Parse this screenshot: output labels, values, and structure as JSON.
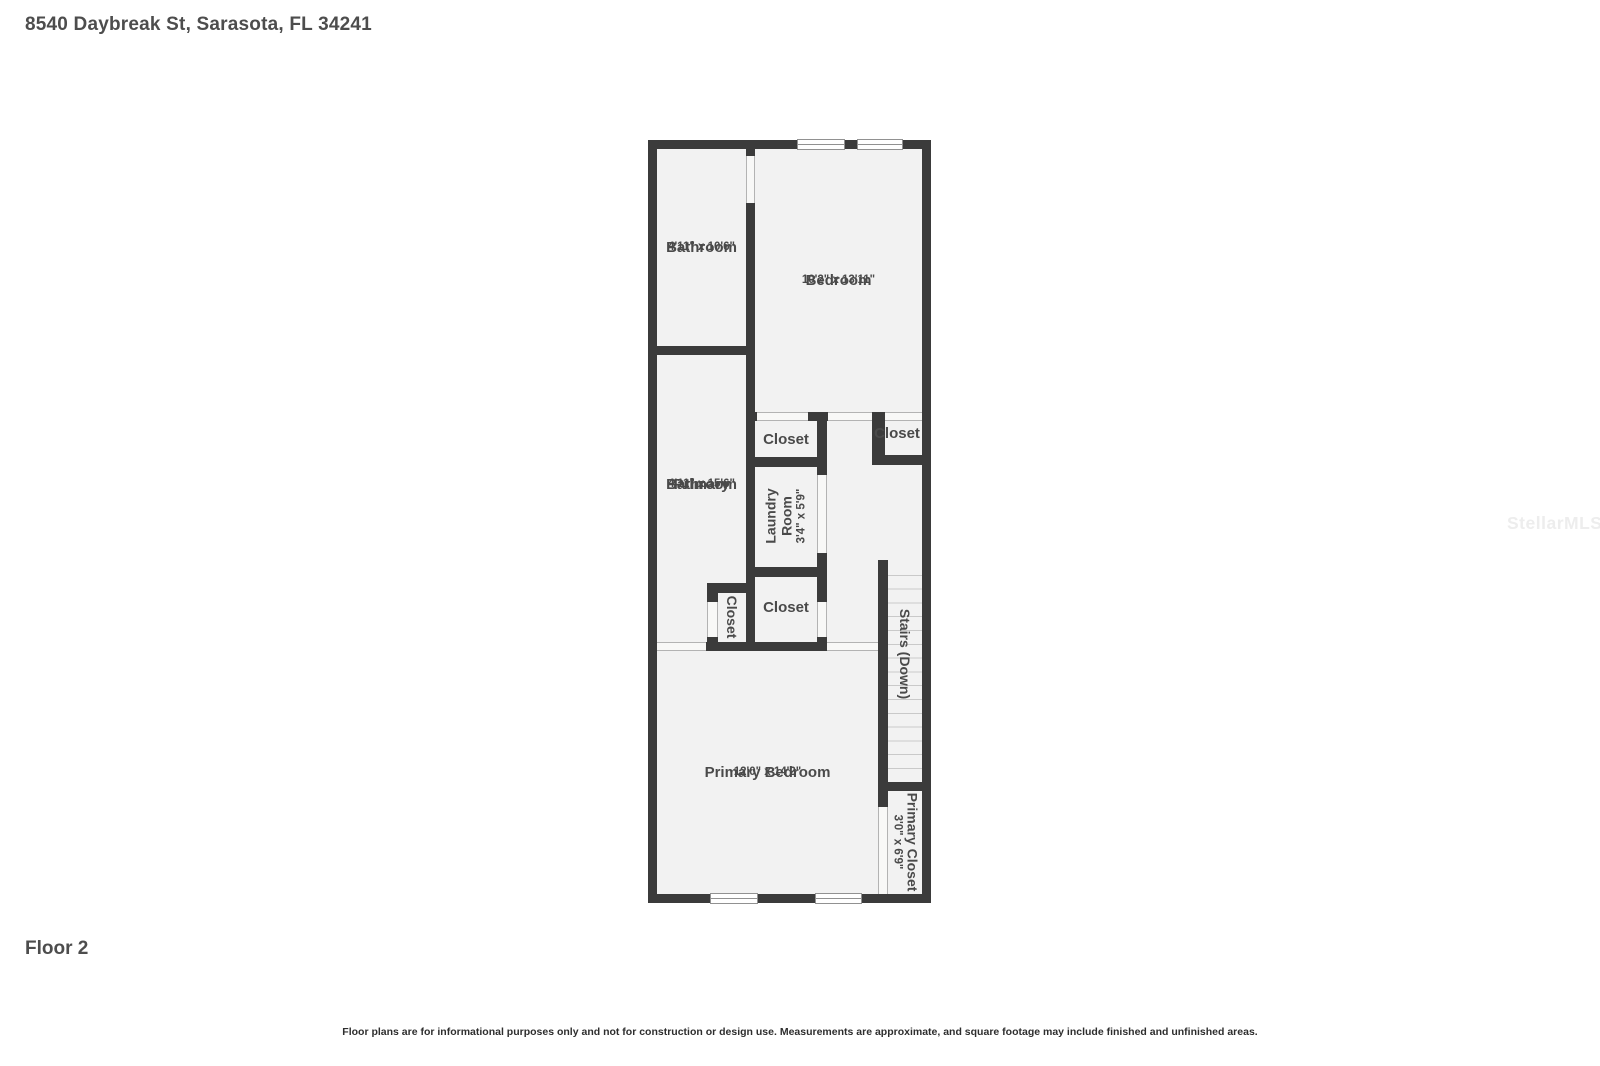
{
  "header": {
    "title": "8540 Daybreak St, Sarasota, FL 34241"
  },
  "watermark": {
    "text": "StellarMLS"
  },
  "floor_plan": {
    "floor_number": "Floor 2",
    "wall_color": "#3b3b3b",
    "floor_color": "#f2f2f2",
    "rooms": {
      "bathroom": {
        "name": "Bathroom",
        "dims": "4'11\" x 10'6\""
      },
      "bedroom": {
        "name": "Bedroom",
        "dims": "10'2\" x 13'11\""
      },
      "closet_top_left": {
        "name": "Closet"
      },
      "closet_top_right": {
        "name": "Closet"
      },
      "laundry_room": {
        "name_line1": "Laundry",
        "name_line2": "Room",
        "dims": "3'4\" x 5'9\""
      },
      "primary_bathroom": {
        "name_line1": "Primary",
        "name_line2": "Bathroom",
        "dims": "4'11\" x 15'6\""
      },
      "closet_side": {
        "name": "Closet"
      },
      "closet_middle": {
        "name": "Closet"
      },
      "stairs": {
        "name": "Stairs (Down)"
      },
      "primary_bedroom": {
        "name": "Primary Bedroom",
        "dims": "12'0\" x 14'2\""
      },
      "primary_closet": {
        "name": "Primary Closet",
        "dims": "3'0\" x 6'9\""
      }
    }
  },
  "footer": {
    "floor_label": "Floor 2",
    "disclaimer": "Floor plans are for informational purposes only and not for construction or design use. Measurements are approximate, and square footage may include finished and unfinished areas."
  }
}
